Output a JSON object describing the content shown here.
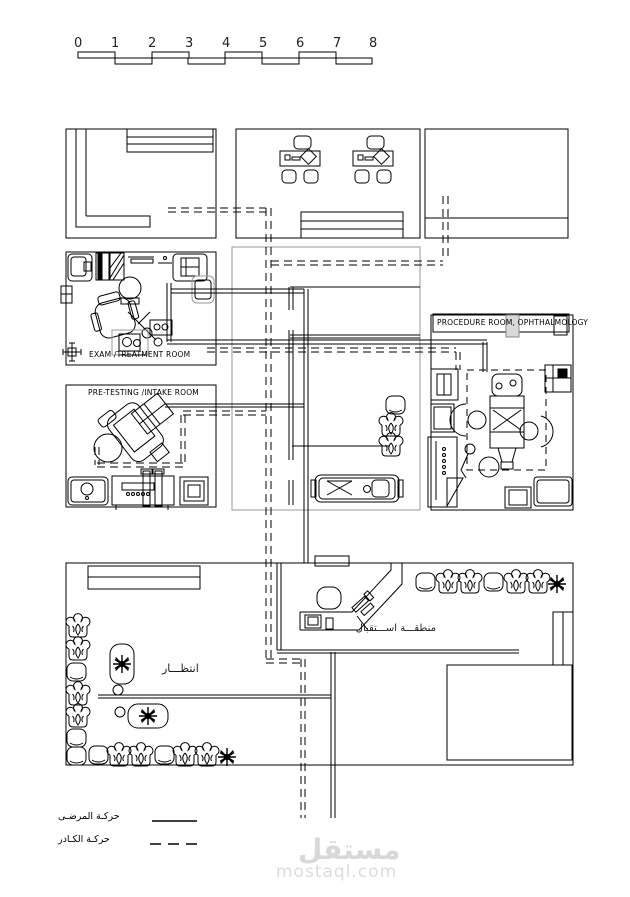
{
  "scale_bar": {
    "numbers": [
      "0",
      "1",
      "2",
      "3",
      "4",
      "5",
      "6",
      "7",
      "8"
    ]
  },
  "labels": {
    "exam_room": "EXAM /TREATMENT ROOM",
    "pretesting_room": "PRE-TESTING /INTAKE ROOM",
    "procedure_room": "PROCEDURE ROOM, OPHTHALMOLOGY",
    "reception_area": "منطقـــة اســـتقبال",
    "waiting_area": "انتظـــار"
  },
  "legend": {
    "patient_movement": "حركـة المرضـى",
    "staff_movement": "حركـة الكـادر"
  },
  "watermark": {
    "name": "مستقل",
    "domain": "mostaql.com"
  },
  "colors": {
    "ink": "#000000",
    "hall_block_outline": "#9a9a9a",
    "door_fill": "#d9d9d9",
    "watermark_text": "#d8d8d8"
  }
}
